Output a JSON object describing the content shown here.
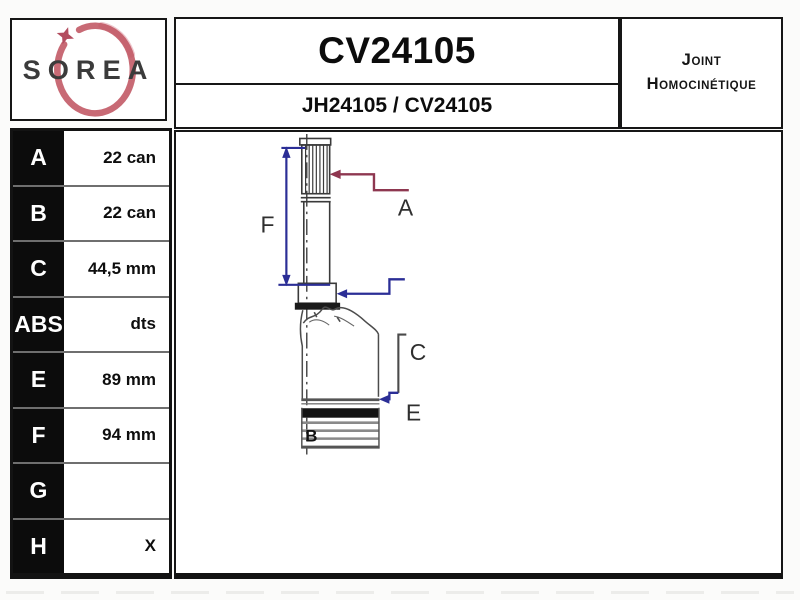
{
  "header": {
    "brand": "SOREA",
    "part_number": "CV24105",
    "reference": "JH24105 / CV24105",
    "category": {
      "line1": "Joint",
      "line2": "Homocinétique"
    }
  },
  "spec_table": {
    "rows": [
      {
        "label": "A",
        "value": "22 can"
      },
      {
        "label": "B",
        "value": "22 can"
      },
      {
        "label": "C",
        "value": "44,5 mm"
      },
      {
        "label": "ABS",
        "value": "dts"
      },
      {
        "label": "E",
        "value": "89 mm"
      },
      {
        "label": "F",
        "value": "94 mm"
      },
      {
        "label": "G",
        "value": ""
      },
      {
        "label": "H",
        "value": "X"
      }
    ]
  },
  "drawing": {
    "labels": {
      "a": "A",
      "b": "B",
      "c": "C",
      "e": "E",
      "f": "F"
    },
    "colors": {
      "dimension_blue": "#2b2e96",
      "dimension_red": "#8e3750",
      "outline_gray": "#3a3a3a",
      "logo_red": "#c05562",
      "table_black": "#0c0c0c"
    }
  }
}
